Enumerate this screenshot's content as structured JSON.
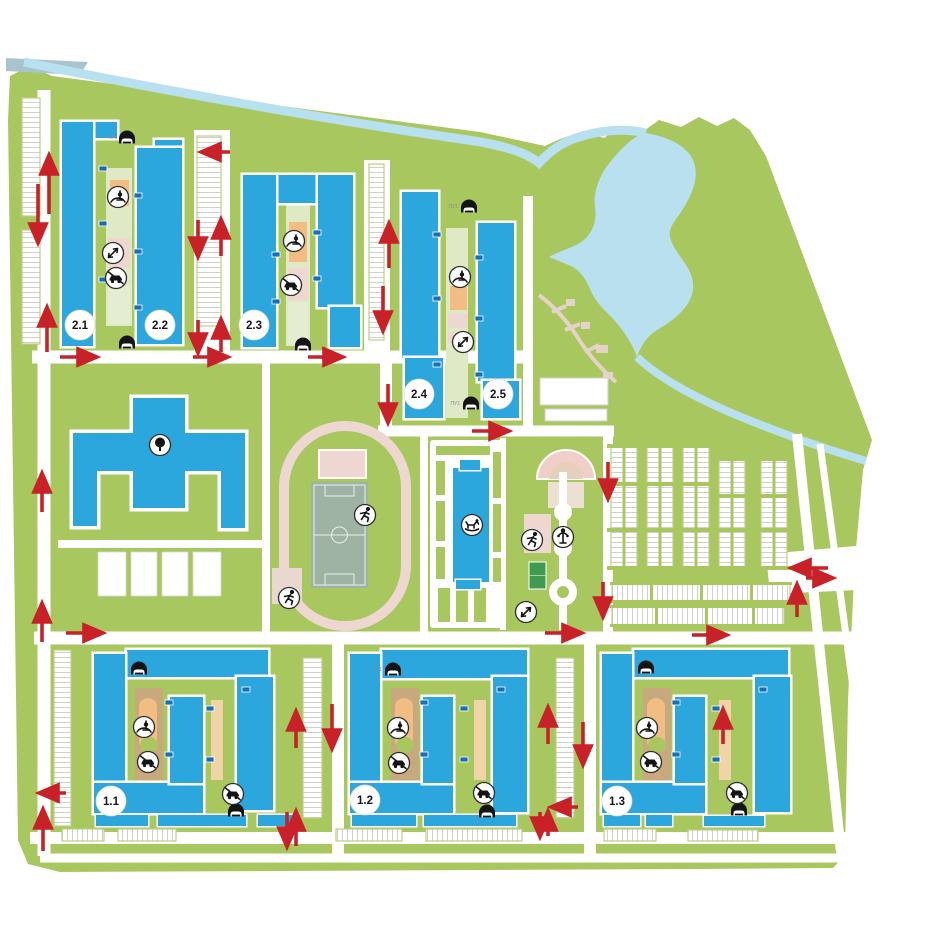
{
  "canvas": {
    "width": 935,
    "height": 935,
    "background": "#ffffff"
  },
  "colors": {
    "lawn_green": "#a9c75f",
    "water_blue": "#b8e0ef",
    "building_blue": "#2ba7de",
    "section_tag_blue": "#176fb8",
    "traffic_arrow_red": "#c92128",
    "track_pink": "#eed7d0",
    "pitch_sage": "#9fb3a4",
    "mini_pitch_green": "#3e9b4f",
    "playground_sand": "#c8a97e",
    "playground_orange": "#f2bd83",
    "courtyard_pale_green": "#dfe9c6",
    "path_beige": "#e3d3c8",
    "road_white": "#ffffff"
  },
  "buildings": [
    {
      "label": "2.1"
    },
    {
      "label": "2.2"
    },
    {
      "label": "2.3"
    },
    {
      "label": "2.4"
    },
    {
      "label": "2.5"
    },
    {
      "label": "1.1"
    },
    {
      "label": "1.2"
    },
    {
      "label": "1.3"
    }
  ],
  "annotations": {
    "parking_entry": "ПУ1"
  },
  "icons": {
    "parking-entrance-icon": "car under canopy — underground parking entrance",
    "playground-icon": "child on swing — playground",
    "no-cars-icon": "crossed-out car — car-free courtyard",
    "runner-icon": "running person — sports area",
    "workout-icon": "double-headed arrow — workout area",
    "rocking-horse-icon": "rocking horse — kindergarten",
    "tree-icon": "tree — school grounds",
    "lamp-icon": "street lamp — park promenade"
  },
  "map_features": [
    "stream",
    "pond",
    "stadium",
    "school",
    "kindergarten",
    "park",
    "parking-lots",
    "residential-blocks"
  ]
}
